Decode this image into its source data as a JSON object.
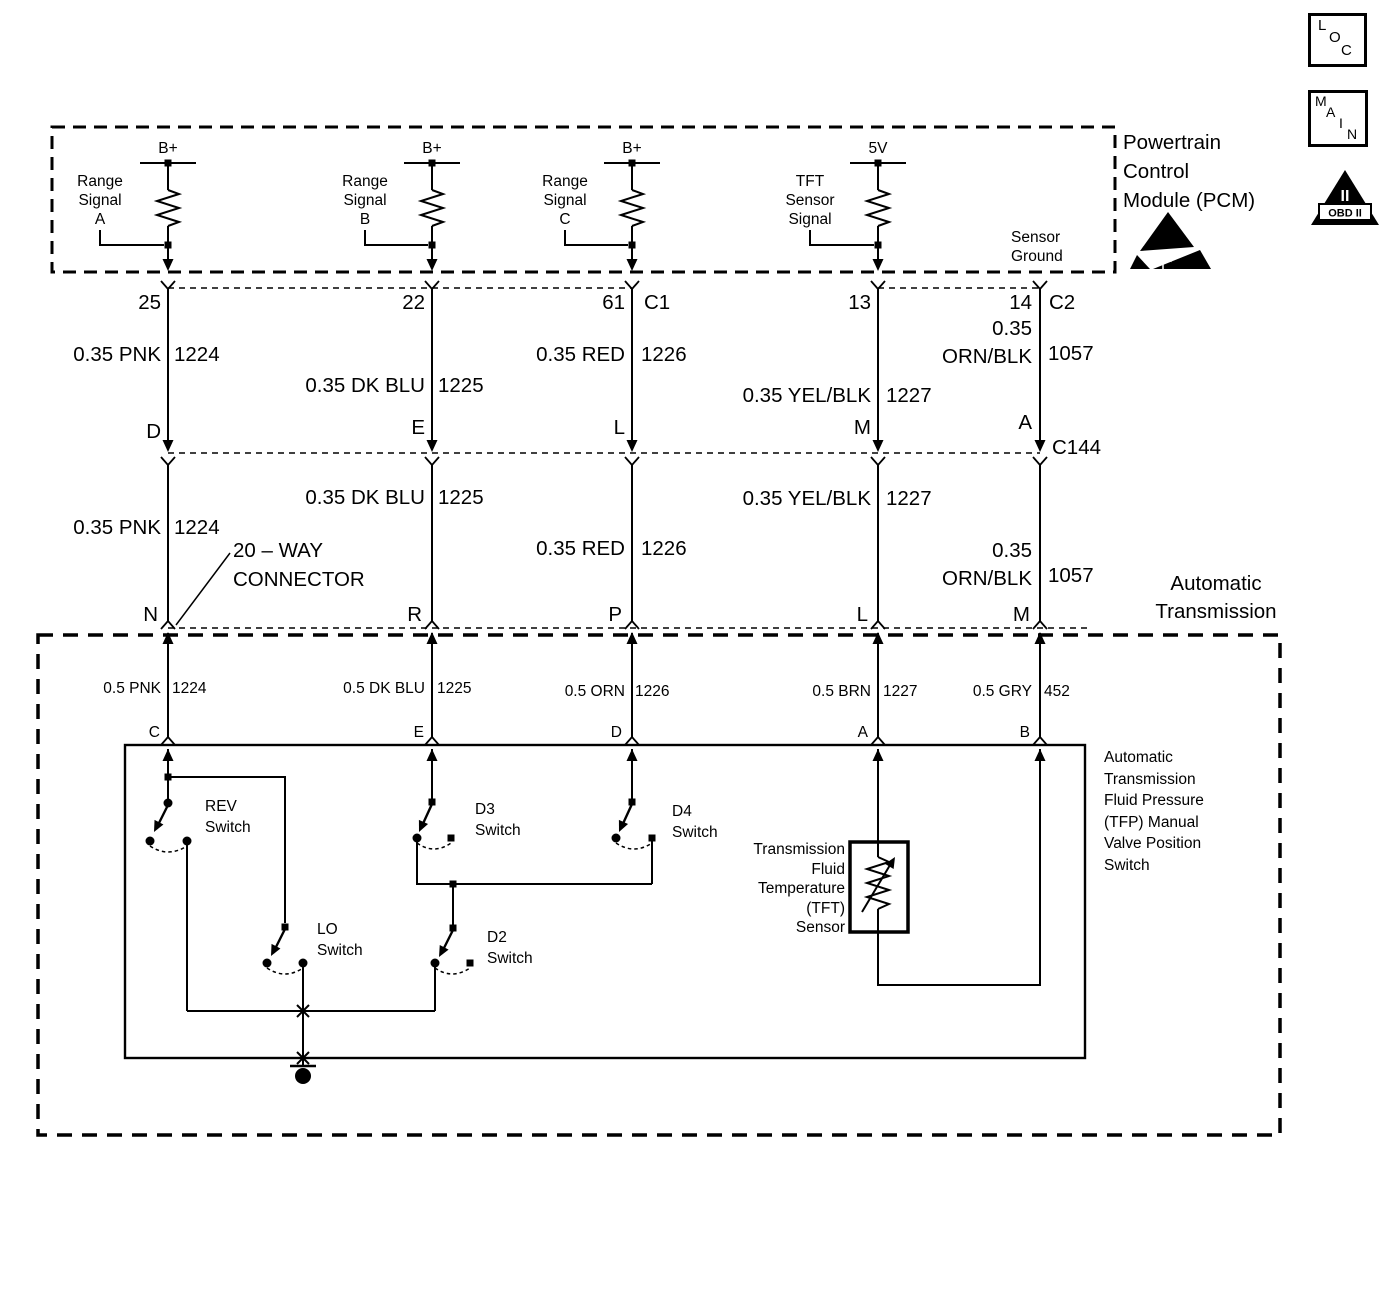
{
  "icons": {
    "loc_letters": [
      "L",
      "O",
      "C"
    ],
    "main_letters": [
      "M",
      "A",
      "I",
      "N"
    ],
    "obd": {
      "numeral": "II",
      "label": "OBD II"
    }
  },
  "pcm": {
    "title_lines": [
      "Powertrain",
      "Control",
      "Module (PCM)"
    ],
    "sensor_ground_lines": [
      "Sensor",
      "Ground"
    ],
    "branches": [
      {
        "supply": "B+",
        "label_lines": [
          "Range",
          "Signal",
          "A"
        ]
      },
      {
        "supply": "B+",
        "label_lines": [
          "Range",
          "Signal",
          "B"
        ]
      },
      {
        "supply": "B+",
        "label_lines": [
          "Range",
          "Signal",
          "C"
        ]
      },
      {
        "supply": "5V",
        "label_lines": [
          "TFT",
          "Sensor",
          "Signal"
        ]
      }
    ]
  },
  "pins": {
    "c1": {
      "name": "C1",
      "numbers": [
        "25",
        "22",
        "61"
      ]
    },
    "c2": {
      "name": "C2",
      "numbers": [
        "13",
        "14"
      ]
    },
    "c144": {
      "name": "C144",
      "letters": [
        "D",
        "E",
        "L",
        "M",
        "A"
      ]
    },
    "twenty_way": {
      "label_lines": [
        "20 – WAY",
        "CONNECTOR"
      ],
      "letters": [
        "N",
        "R",
        "P",
        "L",
        "M"
      ]
    },
    "tfp_switch": {
      "letters": [
        "C",
        "E",
        "D",
        "A",
        "B"
      ]
    }
  },
  "wires_035": [
    {
      "label": "0.35 PNK",
      "circuit": "1224"
    },
    {
      "label": "0.35 DK BLU",
      "circuit": "1225"
    },
    {
      "label": "0.35 RED",
      "circuit": "1226"
    },
    {
      "label": "0.35 YEL/BLK",
      "circuit": "1227"
    },
    {
      "label": "0.35 ORN/BLK",
      "label_lines": [
        "0.35",
        "ORN/BLK"
      ],
      "circuit": "1057"
    }
  ],
  "wires_05": [
    {
      "label": "0.5 PNK",
      "circuit": "1224"
    },
    {
      "label": "0.5 DK BLU",
      "circuit": "1225"
    },
    {
      "label": "0.5 ORN",
      "circuit": "1226"
    },
    {
      "label": "0.5 BRN",
      "circuit": "1227"
    },
    {
      "label": "0.5 GRY",
      "circuit": "452"
    }
  ],
  "transmission": {
    "title_lines": [
      "Automatic",
      "Transmission"
    ],
    "tfp_desc_lines": [
      "Automatic",
      "Transmission",
      "Fluid Pressure",
      "(TFP) Manual",
      "Valve Position",
      "Switch"
    ],
    "tft_label_lines": [
      "Transmission",
      "Fluid",
      "Temperature",
      "(TFT)",
      "Sensor"
    ],
    "switches": {
      "rev": [
        "REV",
        "Switch"
      ],
      "d3": [
        "D3",
        "Switch"
      ],
      "d4": [
        "D4",
        "Switch"
      ],
      "lo": [
        "LO",
        "Switch"
      ],
      "d2": [
        "D2",
        "Switch"
      ]
    }
  },
  "colors": {
    "line": "#000000",
    "background": "#ffffff"
  }
}
